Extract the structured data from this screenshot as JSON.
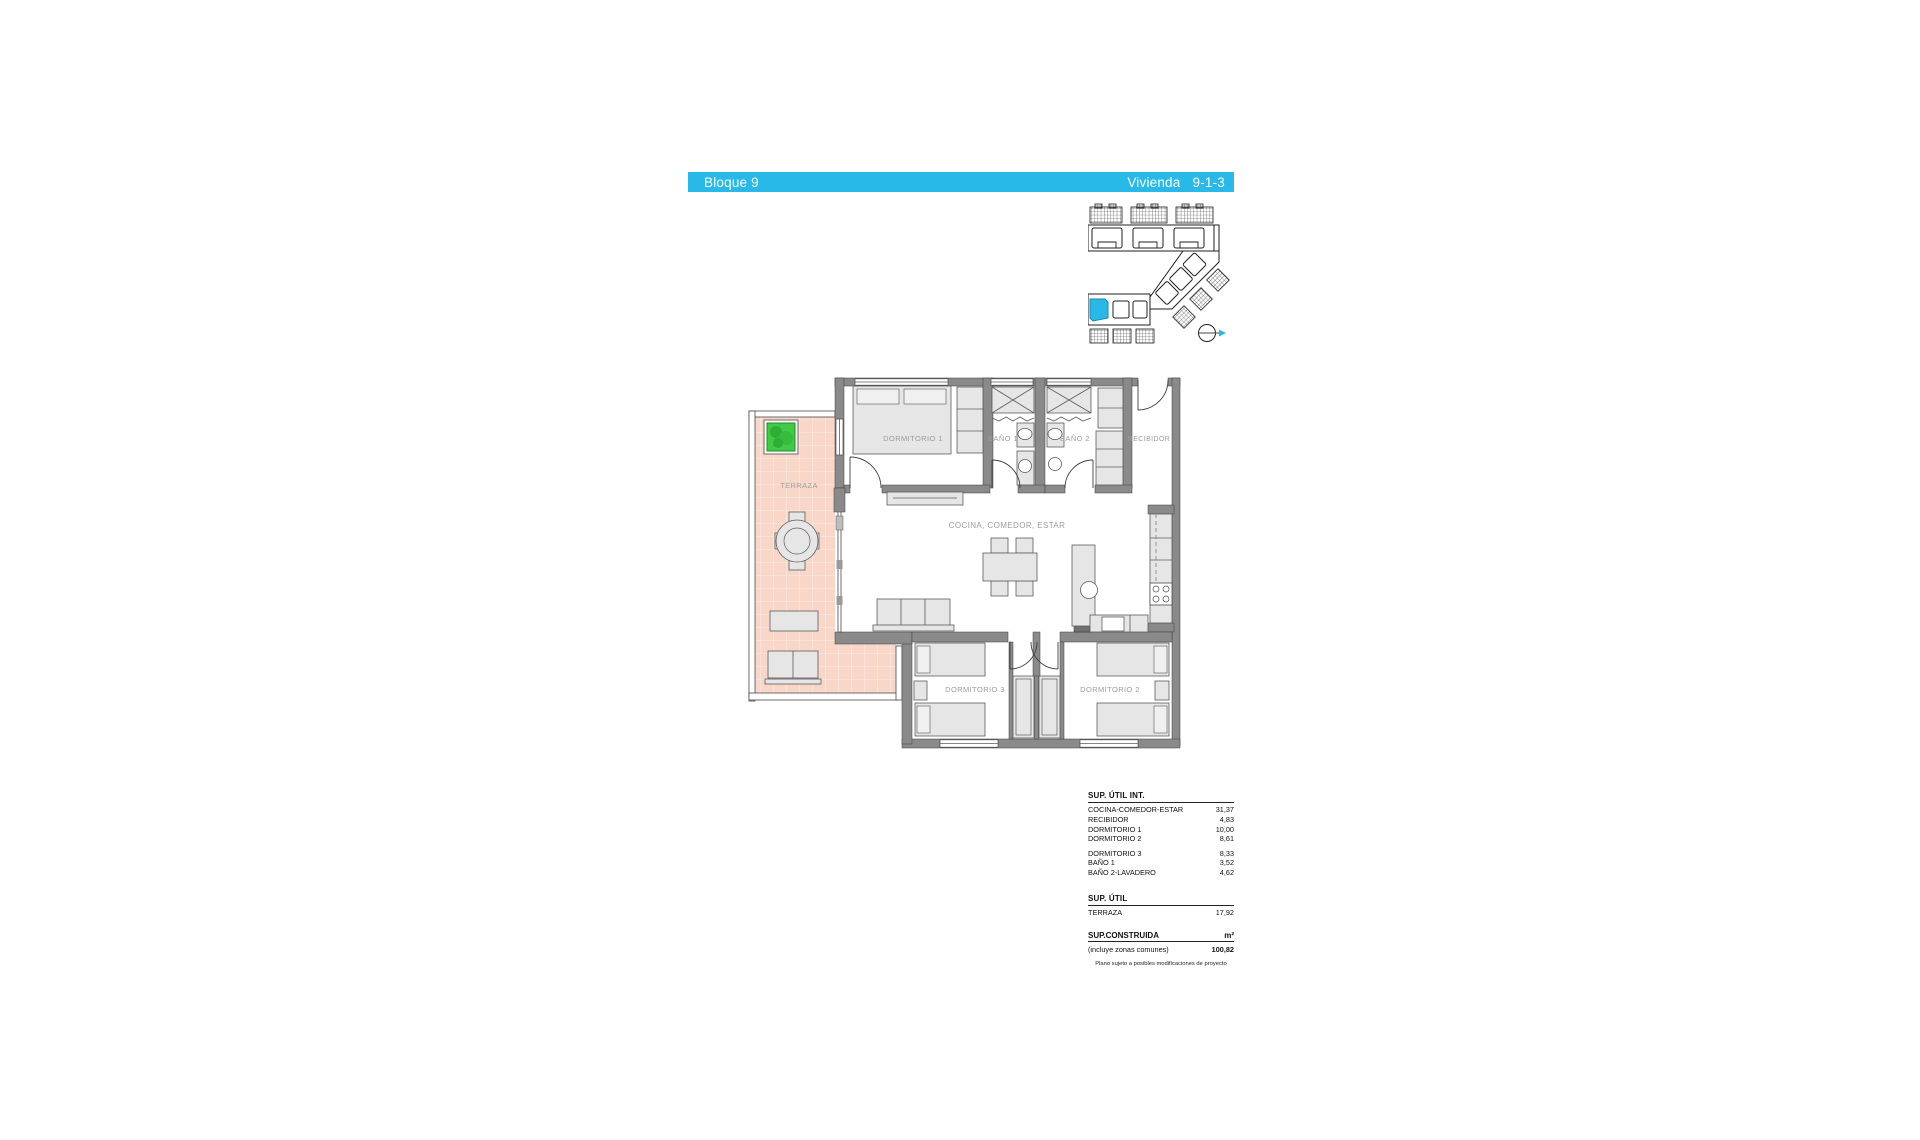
{
  "header": {
    "block_label": "Bloque 9",
    "unit_label": "Vivienda",
    "unit_number": "9-1-3"
  },
  "colors": {
    "accent_cyan": "#29b9e8",
    "terrace_tile": "#f8d7c9",
    "plant_green": "#3fcb44",
    "wall_gray": "#8a8a8a",
    "furniture_gray": "#e6e6e6",
    "label_gray": "#9c9c9c"
  },
  "floor_plan": {
    "rooms": {
      "terraza": "TERRAZA",
      "dormitorio_1": "DORMITORIO 1",
      "bano_1": "BAÑO 1",
      "bano_2": "BAÑO 2",
      "recibidor": "RECIBIDOR",
      "cocina_comedor_estar": "COCINA, COMEDOR, ESTAR",
      "dormitorio_3": "DORMITORIO 3",
      "dormitorio_2": "DORMITORIO 2"
    }
  },
  "surface_table": {
    "util_int": {
      "title": "SUP. ÚTIL INT.",
      "rows": [
        {
          "label": "COCINA-COMEDOR-ESTAR",
          "value": "31,37"
        },
        {
          "label": "RECIBIDOR",
          "value": "4,83"
        },
        {
          "label": "DORMITORIO 1",
          "value": "10,00"
        },
        {
          "label": "DORMITORIO 2",
          "value": "8,61"
        },
        {
          "label": "DORMITORIO 3",
          "value": "8,33"
        },
        {
          "label": "BAÑO 1",
          "value": "3,52"
        },
        {
          "label": "BAÑO 2-LAVADERO",
          "value": "4,62"
        }
      ]
    },
    "util": {
      "title": "SUP. ÚTIL",
      "rows": [
        {
          "label": "TERRAZA",
          "value": "17,92"
        }
      ]
    },
    "construida": {
      "title": "SUP.CONSTRUIDA",
      "unit": "m²",
      "note": "(incluye zonas comunes)",
      "value": "100,82"
    },
    "footnote": "Plano sujeto a posibles modificaciones de proyecto"
  }
}
